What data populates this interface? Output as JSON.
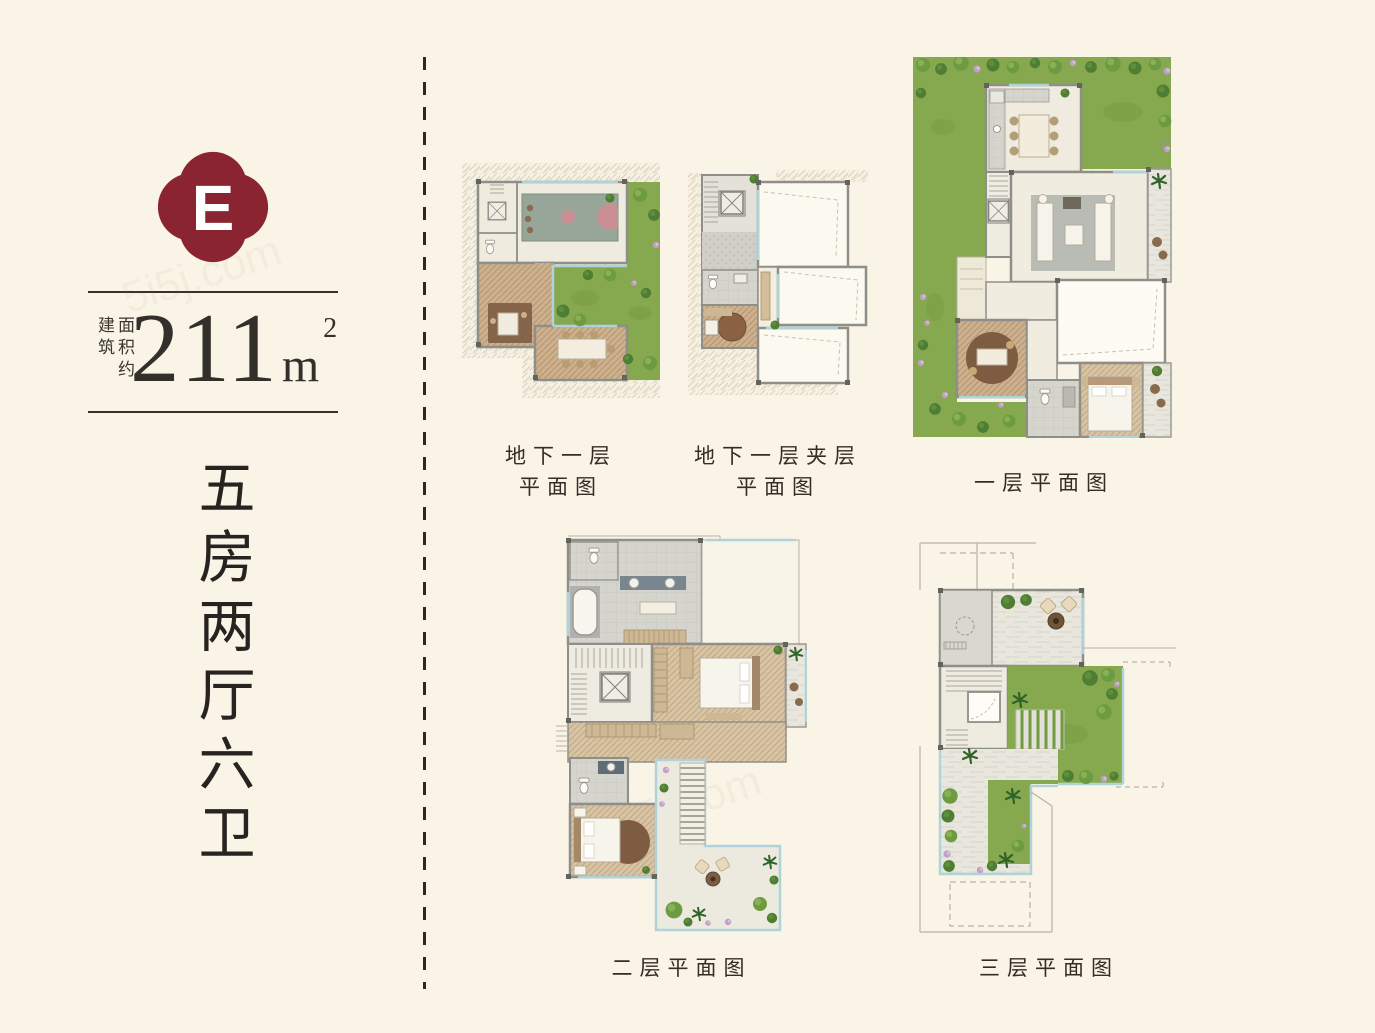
{
  "badge": {
    "letter": "E",
    "color": "#8A2430"
  },
  "area": {
    "label_col1": "建筑",
    "label_col2": "面积约",
    "value": "211",
    "unit": "m",
    "sup": "2"
  },
  "headline": {
    "vertical_text": "五房两厅六卫"
  },
  "plans": [
    {
      "id": "basement",
      "caption_lines": [
        "地下一层",
        "平面图"
      ]
    },
    {
      "id": "basement-mezzanine",
      "caption_lines": [
        "地下一层夹层",
        "平面图"
      ]
    },
    {
      "id": "floor-1",
      "caption_lines": [
        "一层平面图"
      ]
    },
    {
      "id": "floor-2",
      "caption_lines": [
        "二层平面图"
      ]
    },
    {
      "id": "floor-3",
      "caption_lines": [
        "三层平面图"
      ]
    }
  ],
  "watermark": "5i5j.com",
  "colors": {
    "background": "#FAF4E7",
    "badge_red": "#8A2430",
    "ink": "#2E2A25",
    "grass_green": "#86A84E",
    "wall_gray": "#8F8F89",
    "wood_tan": "#CDB08D",
    "glazing_blue": "#AED3DA",
    "court_pink": "#C98F93"
  }
}
